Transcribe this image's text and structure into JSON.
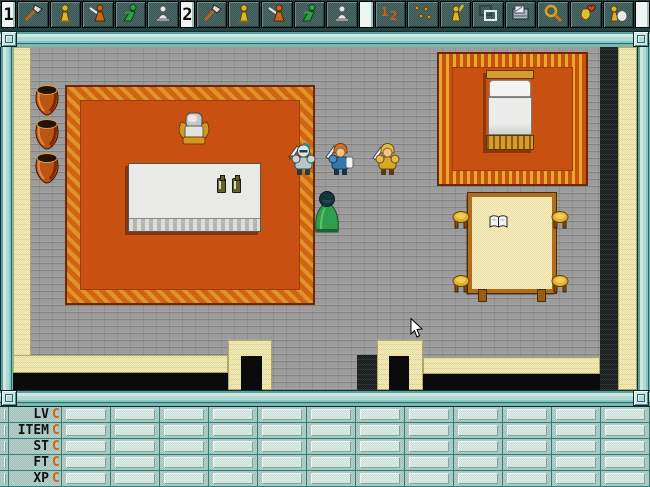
{
  "window": {
    "width": 650,
    "height": 487,
    "kind": "top-down-rpg-room"
  },
  "toolbar": {
    "slots": [
      {
        "kind": "marker",
        "label": "1"
      },
      {
        "kind": "icon",
        "name": "hand-axe"
      },
      {
        "kind": "icon",
        "name": "gold-statue"
      },
      {
        "kind": "icon",
        "name": "orange-warrior"
      },
      {
        "kind": "icon",
        "name": "green-runner"
      },
      {
        "kind": "icon",
        "name": "white-kneeler"
      },
      {
        "kind": "marker",
        "label": "2"
      },
      {
        "kind": "icon",
        "name": "hand-axe"
      },
      {
        "kind": "icon",
        "name": "gold-statue"
      },
      {
        "kind": "icon",
        "name": "orange-warrior"
      },
      {
        "kind": "icon",
        "name": "green-runner"
      },
      {
        "kind": "icon",
        "name": "white-kneeler"
      },
      {
        "kind": "marker",
        "label": ""
      },
      {
        "kind": "icon",
        "name": "swap-order"
      },
      {
        "kind": "icon",
        "name": "gold-shards"
      },
      {
        "kind": "icon",
        "name": "gold-victor"
      },
      {
        "kind": "icon",
        "name": "frame-tool"
      },
      {
        "kind": "icon",
        "name": "map-case"
      },
      {
        "kind": "icon",
        "name": "magnifier"
      },
      {
        "kind": "icon",
        "name": "heart-charm"
      },
      {
        "kind": "icon",
        "name": "sack-carrier"
      },
      {
        "kind": "marker",
        "label": ""
      }
    ]
  },
  "status_panel": {
    "columns": 12,
    "rows": [
      {
        "label": "LV",
        "value": "C"
      },
      {
        "label": "ITEM",
        "value": "C"
      },
      {
        "label": "ST",
        "value": "C"
      },
      {
        "label": "FT",
        "value": "C"
      },
      {
        "label": "XP",
        "value": "C"
      }
    ]
  },
  "scene": {
    "sprites": [
      "clay-pot",
      "clay-pot",
      "clay-pot",
      "armchair",
      "dining-table",
      "bottle",
      "bottle",
      "bed",
      "knight-silver",
      "knight-blue",
      "knight-gold",
      "green-cloak-figure",
      "reading-table",
      "open-book",
      "stool",
      "stool",
      "stool",
      "stool"
    ],
    "cursor": "arrow-pointer"
  },
  "colors": {
    "frame_teal": "#79b8b4",
    "toolbar_dark": "#1c3836",
    "floor_gray": "#9c9c9c",
    "wall_yellow": "#e6de96",
    "carpet_orange": "#c85010",
    "carpet_trim": "#e8a828",
    "status_bg": "#a9c6be",
    "status_value_orange": "#e05a10",
    "void_black": "#0b0b0b"
  }
}
